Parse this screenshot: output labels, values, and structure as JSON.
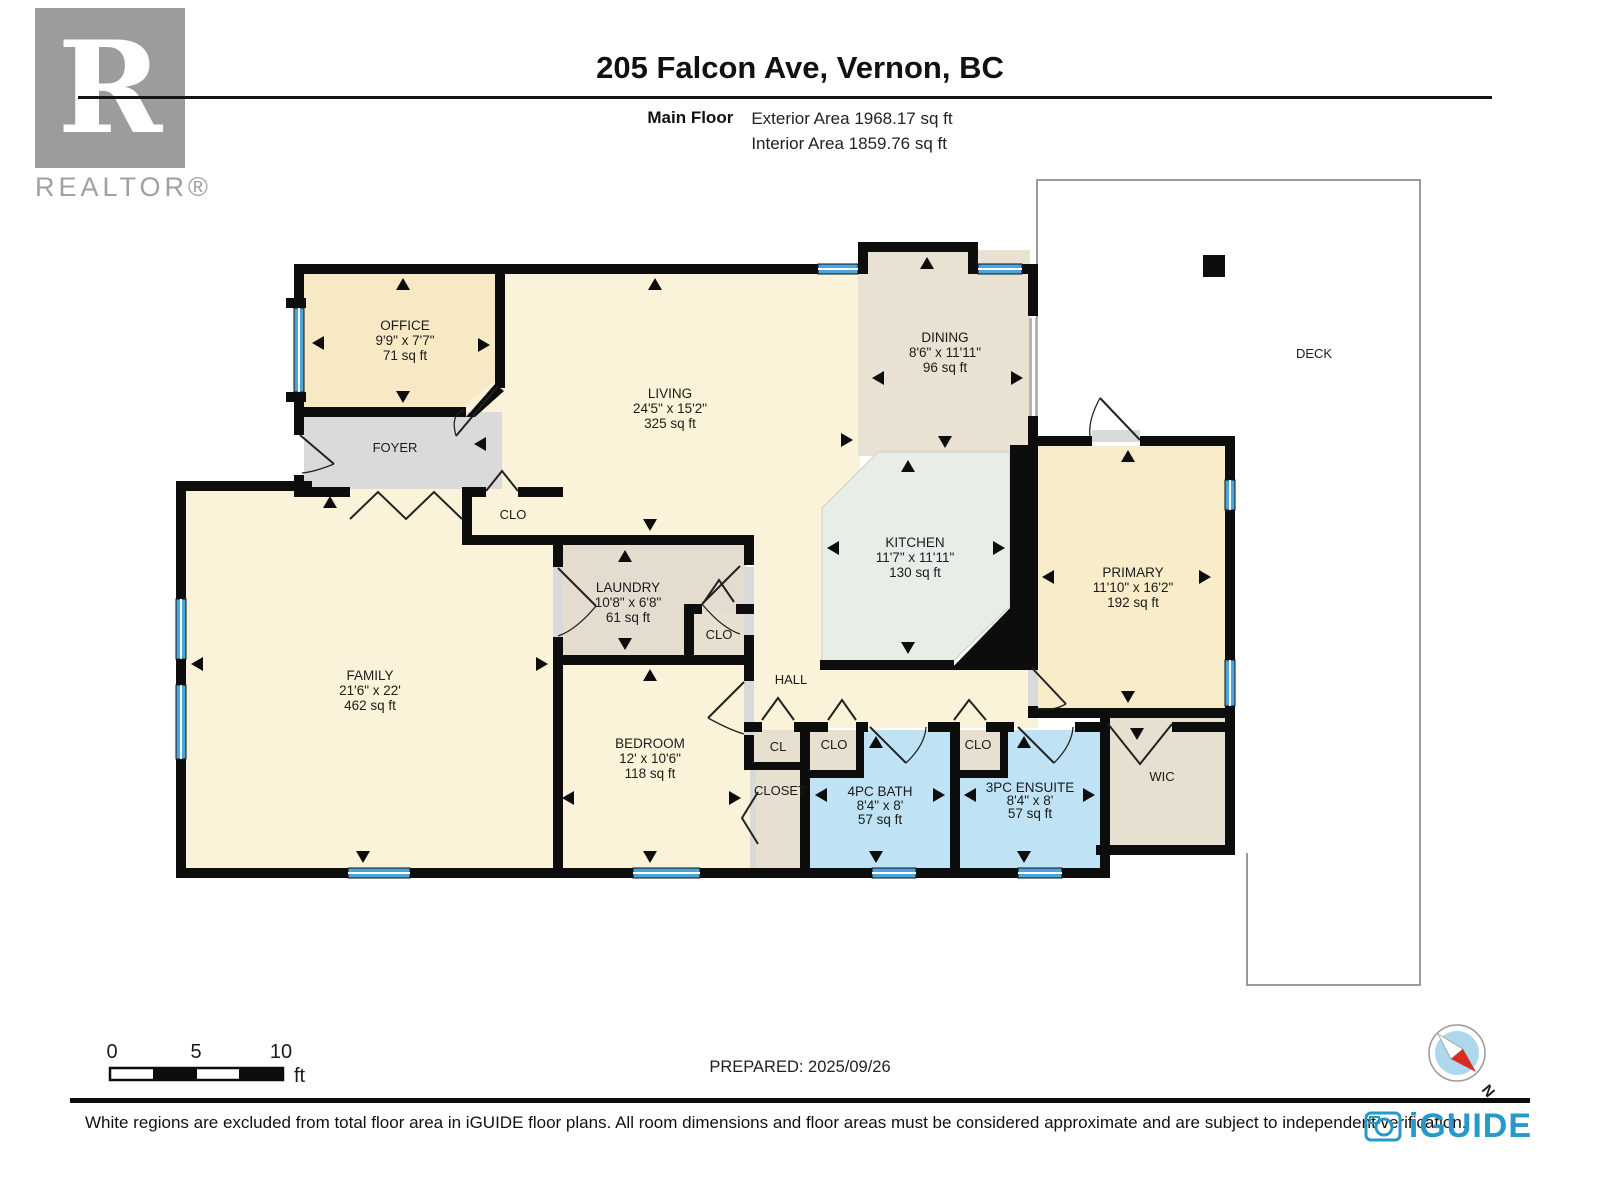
{
  "header": {
    "title": "205 Falcon Ave, Vernon, BC",
    "floor_label": "Main Floor",
    "exterior_area": "Exterior Area 1968.17 sq ft",
    "interior_area": "Interior Area 1859.76 sq ft"
  },
  "branding": {
    "realtor_letter": "R",
    "realtor_wordmark": "REALTOR®",
    "iguide_wordmark": "iGUIDE"
  },
  "rooms": [
    {
      "name": "OFFICE",
      "dims": "9'9\" x 7'7\"",
      "area": "71 sq ft"
    },
    {
      "name": "LIVING",
      "dims": "24'5\" x 15'2\"",
      "area": "325 sq ft"
    },
    {
      "name": "DINING",
      "dims": "8'6\" x 11'11\"",
      "area": "96 sq ft"
    },
    {
      "name": "KITCHEN",
      "dims": "11'7\" x 11'11\"",
      "area": "130 sq ft"
    },
    {
      "name": "PRIMARY",
      "dims": "11'10\" x 16'2\"",
      "area": "192 sq ft"
    },
    {
      "name": "FAMILY",
      "dims": "21'6\" x 22'",
      "area": "462 sq ft"
    },
    {
      "name": "LAUNDRY",
      "dims": "10'8\" x 6'8\"",
      "area": "61 sq ft"
    },
    {
      "name": "BEDROOM",
      "dims": "12' x 10'6\"",
      "area": "118 sq ft"
    },
    {
      "name": "4PC BATH",
      "dims": "8'4\" x 8'",
      "area": "57 sq ft"
    },
    {
      "name": "3PC ENSUITE",
      "dims": "8'4\" x 8'",
      "area": "57 sq ft"
    }
  ],
  "labels": {
    "foyer": "FOYER",
    "hall": "HALL",
    "deck": "DECK",
    "wic": "WIC",
    "cl": "CL",
    "closet": "CLOSET",
    "clo": "CLO"
  },
  "scale": {
    "t0": "0",
    "t5": "5",
    "t10": "10",
    "unit": "ft"
  },
  "prepared_label": "PREPARED: 2025/09/26",
  "compass": {
    "north": "N"
  },
  "footer": {
    "disclaimer": "White regions are excluded from total floor area in iGUIDE floor plans. All room dimensions and floor areas must be considered approximate and are subject to independent verification."
  }
}
